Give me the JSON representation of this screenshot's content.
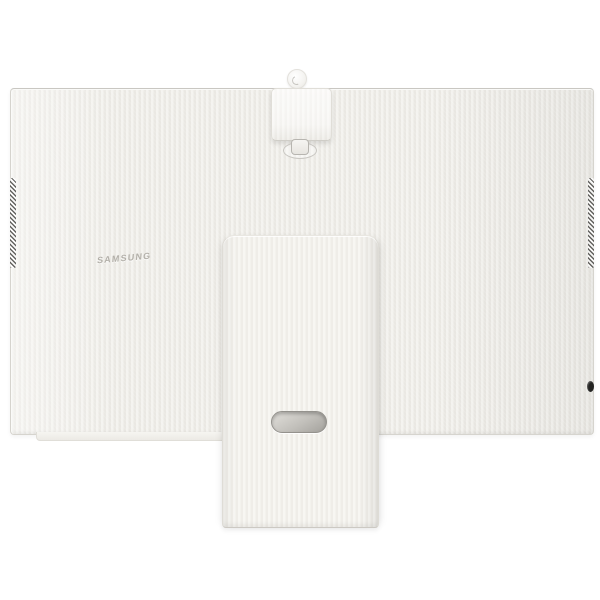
{
  "scene": {
    "description": "Rear view product photo of a white monitor: large textured back panel, detachable camera module at top center, wide flat stand column in front, pill-shaped cable routing hole in the stand, dark hatched vent strips on both side edges, small dark power button on right edge, faint brand logo on upper-left of the panel."
  },
  "monitor": {
    "brand_logo": "SAMSUNG",
    "components": {
      "panel": "monitor-back-panel",
      "camera": "detachable-camera-module",
      "stand": "stand-column",
      "cable_hole": "cable-routing-hole",
      "vents": [
        "left-vent-strip",
        "right-vent-strip"
      ],
      "button": "power-jog-button"
    }
  },
  "colors": {
    "bg": "#ffffff",
    "panel_base": "#f0efea",
    "panel_stripe_light": "#f4f3ef",
    "panel_stripe_dark": "#eae8e3",
    "panel_edge_light": "#fafaf8",
    "panel_edge_dark": "#d6d4ce",
    "stand_base": "#f5f4f0",
    "stand_stripe_light": "#f7f6f2",
    "stand_stripe_dark": "#efede8",
    "stand_edge": "#dedcd6",
    "vent_dark": "#4c4b48",
    "logo_gray": "#b3b0a9",
    "camera_white": "#f7f6f3",
    "camera_border": "#e0ded8",
    "ring_border": "#c9c7c2",
    "tab_border": "#b7b5b0",
    "hole_dark": "#a3a19c",
    "hole_light": "#dcdad5",
    "button_dark": "#242422"
  }
}
